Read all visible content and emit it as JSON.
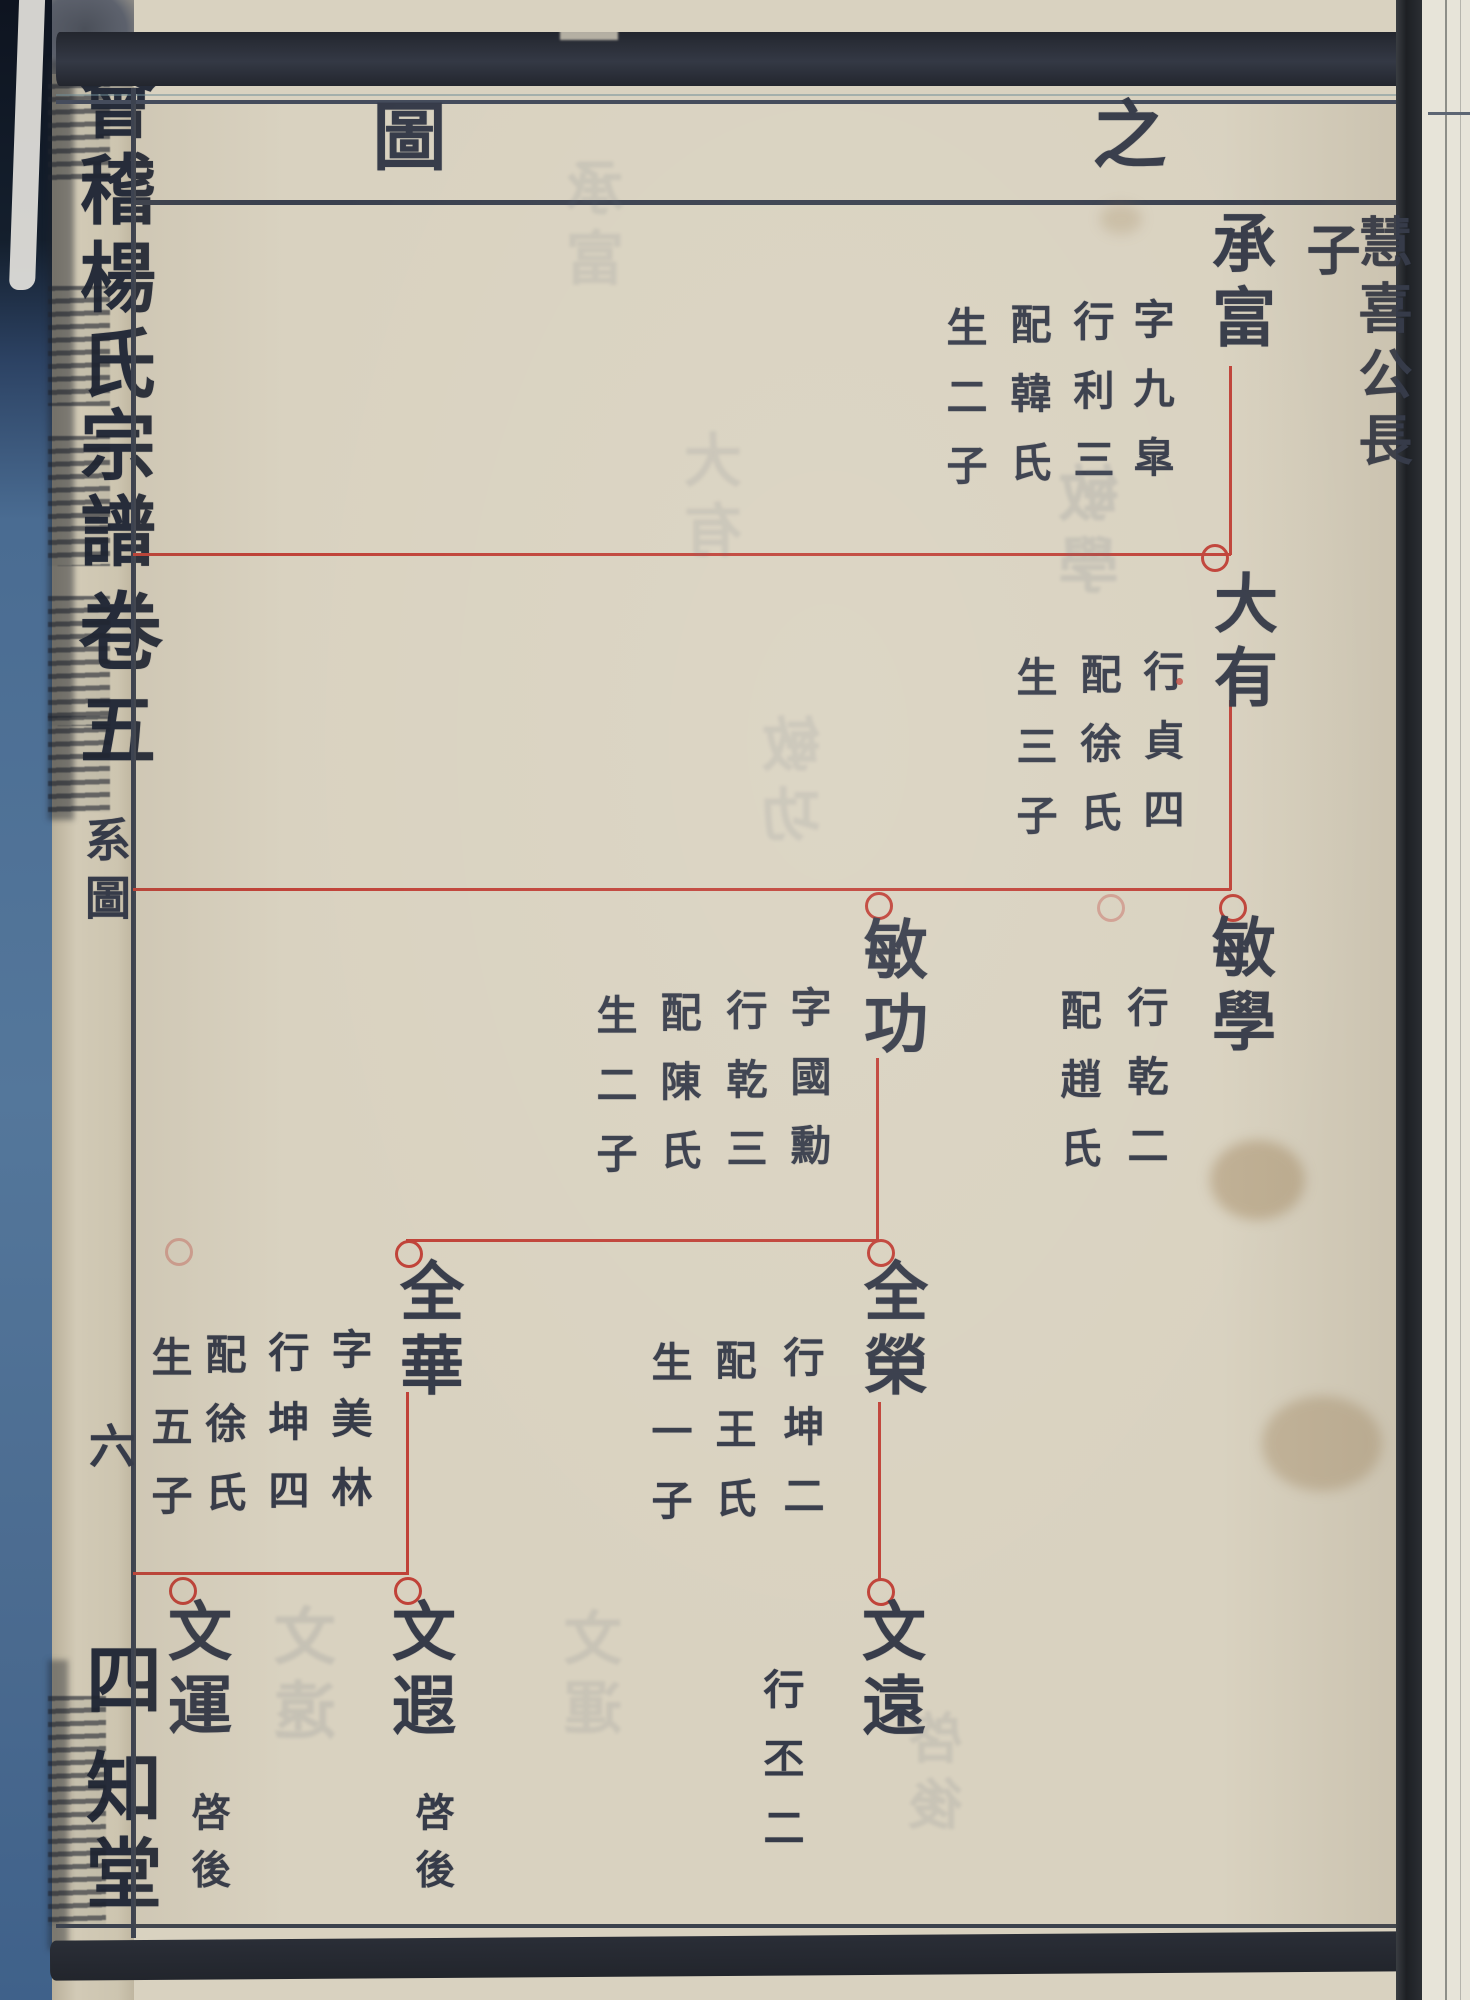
{
  "header": {
    "title_right_char": "之",
    "title_left_char": "圖"
  },
  "spine": {
    "title_chars": [
      "會",
      "稽",
      "楊",
      "氏",
      "宗",
      "譜"
    ],
    "volume_chars": [
      "卷",
      "五"
    ],
    "section_label": "系圖",
    "page_number": "六",
    "hall_chars": [
      "四",
      "知",
      "堂"
    ]
  },
  "tree": {
    "ancestor_note": {
      "lineage": "慧喜公長",
      "suffix": "子"
    },
    "nodes": [
      {
        "name": "承富",
        "details": [
          "字九皐",
          "行利三",
          "配韓氏",
          "生二子"
        ]
      },
      {
        "name": "大有",
        "details": [
          "行貞四",
          "配徐氏",
          "生三子"
        ]
      },
      {
        "name": "敏學",
        "details": [
          "行乾二",
          "配趙氏"
        ]
      },
      {
        "name": "敏功",
        "details": [
          "字國勳",
          "行乾三",
          "配陳氏",
          "生二子"
        ]
      },
      {
        "name": "全華",
        "details": [
          "字美林",
          "行坤四",
          "配徐氏",
          "生五子"
        ]
      },
      {
        "name": "全榮",
        "details": [
          "行坤二",
          "配王氏",
          "生一子"
        ]
      },
      {
        "name": "文運",
        "note": "啓後"
      },
      {
        "name": "文遐",
        "note": "啓後"
      },
      {
        "name": "文遠",
        "details": [
          "行丕二"
        ]
      }
    ]
  },
  "ghost_bleedthrough": [
    "承富",
    "大有",
    "敏學",
    "敏功",
    "文遠",
    "文運",
    "啓後"
  ],
  "colors": {
    "paper": "#d9d2c0",
    "ink": "#363b49",
    "tree_line_red": "#c04238",
    "spine_blue": "#54779b",
    "gutter_dark": "#24272d"
  }
}
